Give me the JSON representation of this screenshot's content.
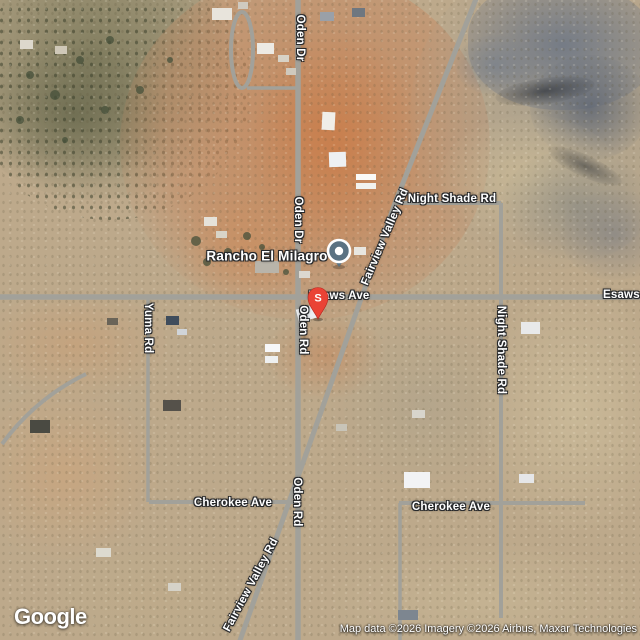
{
  "place": {
    "name": "Rancho El Milagro"
  },
  "markers": {
    "place_pin": "place-pin",
    "s_pin_letter": "S"
  },
  "roads": {
    "oden_dr_top": "Oden Dr",
    "oden_dr_mid": "Oden Dr",
    "oden_rd_upper": "Oden Rd",
    "oden_rd_lower": "Oden Rd",
    "yuma_rd": "Yuma Rd",
    "night_shade_h": "Night Shade Rd",
    "night_shade_v": "Night Shade Rd",
    "fairview_upper": "Fairview Valley Rd",
    "fairview_lower": "Fairview Valley Rd",
    "esaws_center": "Esaws Ave",
    "esaws_right": "Esaws",
    "cherokee_left": "Cherokee Ave",
    "cherokee_right": "Cherokee Ave"
  },
  "attribution": {
    "logo": "Google",
    "text": "Map data ©2026 Imagery ©2026 Airbus, Maxar Technologies"
  },
  "colors": {
    "pin_red": "#EA4335",
    "place_pin_fill": "#5B7282",
    "road_gray": "#A2A19A"
  }
}
